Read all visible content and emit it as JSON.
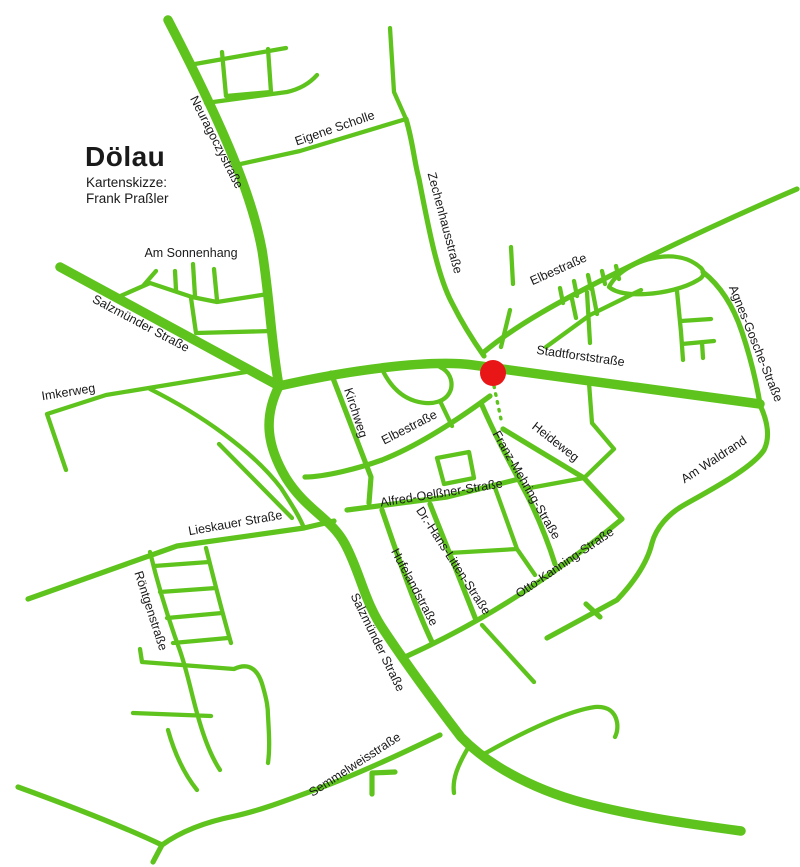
{
  "map": {
    "title": "Dölau",
    "subtitle_line1": "Kartenskizze:",
    "subtitle_line2": "Frank Praßler",
    "colors": {
      "road": "#5ec41d",
      "marker": "#e81616",
      "label": "#1a1a1a",
      "background": "#ffffff"
    },
    "marker": {
      "shape": "red-dot"
    },
    "streets": [
      {
        "name": "Neuragoczystraße"
      },
      {
        "name": "Eigene Scholle"
      },
      {
        "name": "Zechenhausstraße"
      },
      {
        "name": "Am Sonnenhang"
      },
      {
        "name": "Salzmünder Straße"
      },
      {
        "name": "Imkerweg"
      },
      {
        "name": "Elbestraße"
      },
      {
        "name": "Stadtforststraße"
      },
      {
        "name": "Agnes-Gosche-Straße"
      },
      {
        "name": "Kirchweg"
      },
      {
        "name": "Elbestraße"
      },
      {
        "name": "Heideweg"
      },
      {
        "name": "Am Waldrand"
      },
      {
        "name": "Franz-Mehring-Straße"
      },
      {
        "name": "Alfred-Oelßner-Straße"
      },
      {
        "name": "Dr.-Hans-Litten-Straße"
      },
      {
        "name": "Hufelandstraße"
      },
      {
        "name": "Otto-Kanning-Straße"
      },
      {
        "name": "Lieskauer Straße"
      },
      {
        "name": "Röntgenstraße"
      },
      {
        "name": "Salzmünder Straße"
      },
      {
        "name": "Semmelweisstraße"
      }
    ]
  }
}
